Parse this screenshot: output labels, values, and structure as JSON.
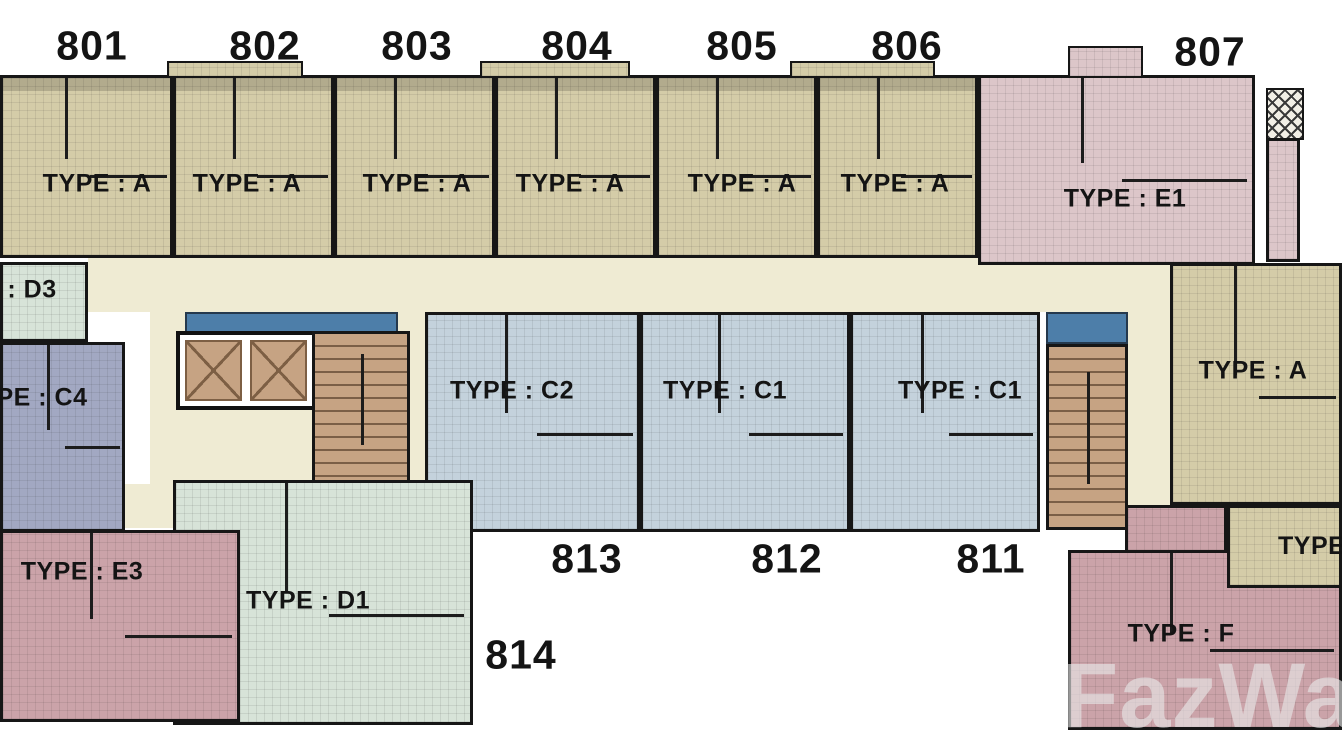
{
  "watermark": "FazWaz",
  "colors": {
    "type_a_tan": "#D4CCA8",
    "type_c_blue": "#C4D2DC",
    "type_c4_slate": "#A2A8C2",
    "type_d_green": "#D7E3D8",
    "type_e1_pink": "#DCC6C9",
    "type_e3_f_mauve": "#CBA3A9",
    "hallway_cream": "#EFEBD3",
    "core_brown": "#C6A383",
    "balcony_blue": "#4D7EA9",
    "wall_black": "#161616"
  },
  "units": {
    "u801": {
      "number": "801",
      "type": "TYPE : A"
    },
    "u802": {
      "number": "802",
      "type": "TYPE : A"
    },
    "u803": {
      "number": "803",
      "type": "TYPE : A"
    },
    "u804": {
      "number": "804",
      "type": "TYPE : A"
    },
    "u805": {
      "number": "805",
      "type": "TYPE : A"
    },
    "u806": {
      "number": "806",
      "type": "TYPE : A"
    },
    "u807": {
      "number": "807",
      "type": "TYPE : E1"
    },
    "u811": {
      "number": "811",
      "type": "TYPE : C1"
    },
    "u812": {
      "number": "812",
      "type": "TYPE : C1"
    },
    "u813": {
      "number": "813",
      "type": "TYPE : C2"
    },
    "u814": {
      "number": "814",
      "type": "TYPE : D1"
    },
    "d3": {
      "type": ": D3"
    },
    "c4": {
      "type": "PE : C4"
    },
    "a_right": {
      "type": "TYPE : A"
    },
    "e3": {
      "type": "TYPE : E3"
    },
    "f": {
      "type": "TYPE : F"
    },
    "partial_right": {
      "type": "TYPE"
    }
  }
}
